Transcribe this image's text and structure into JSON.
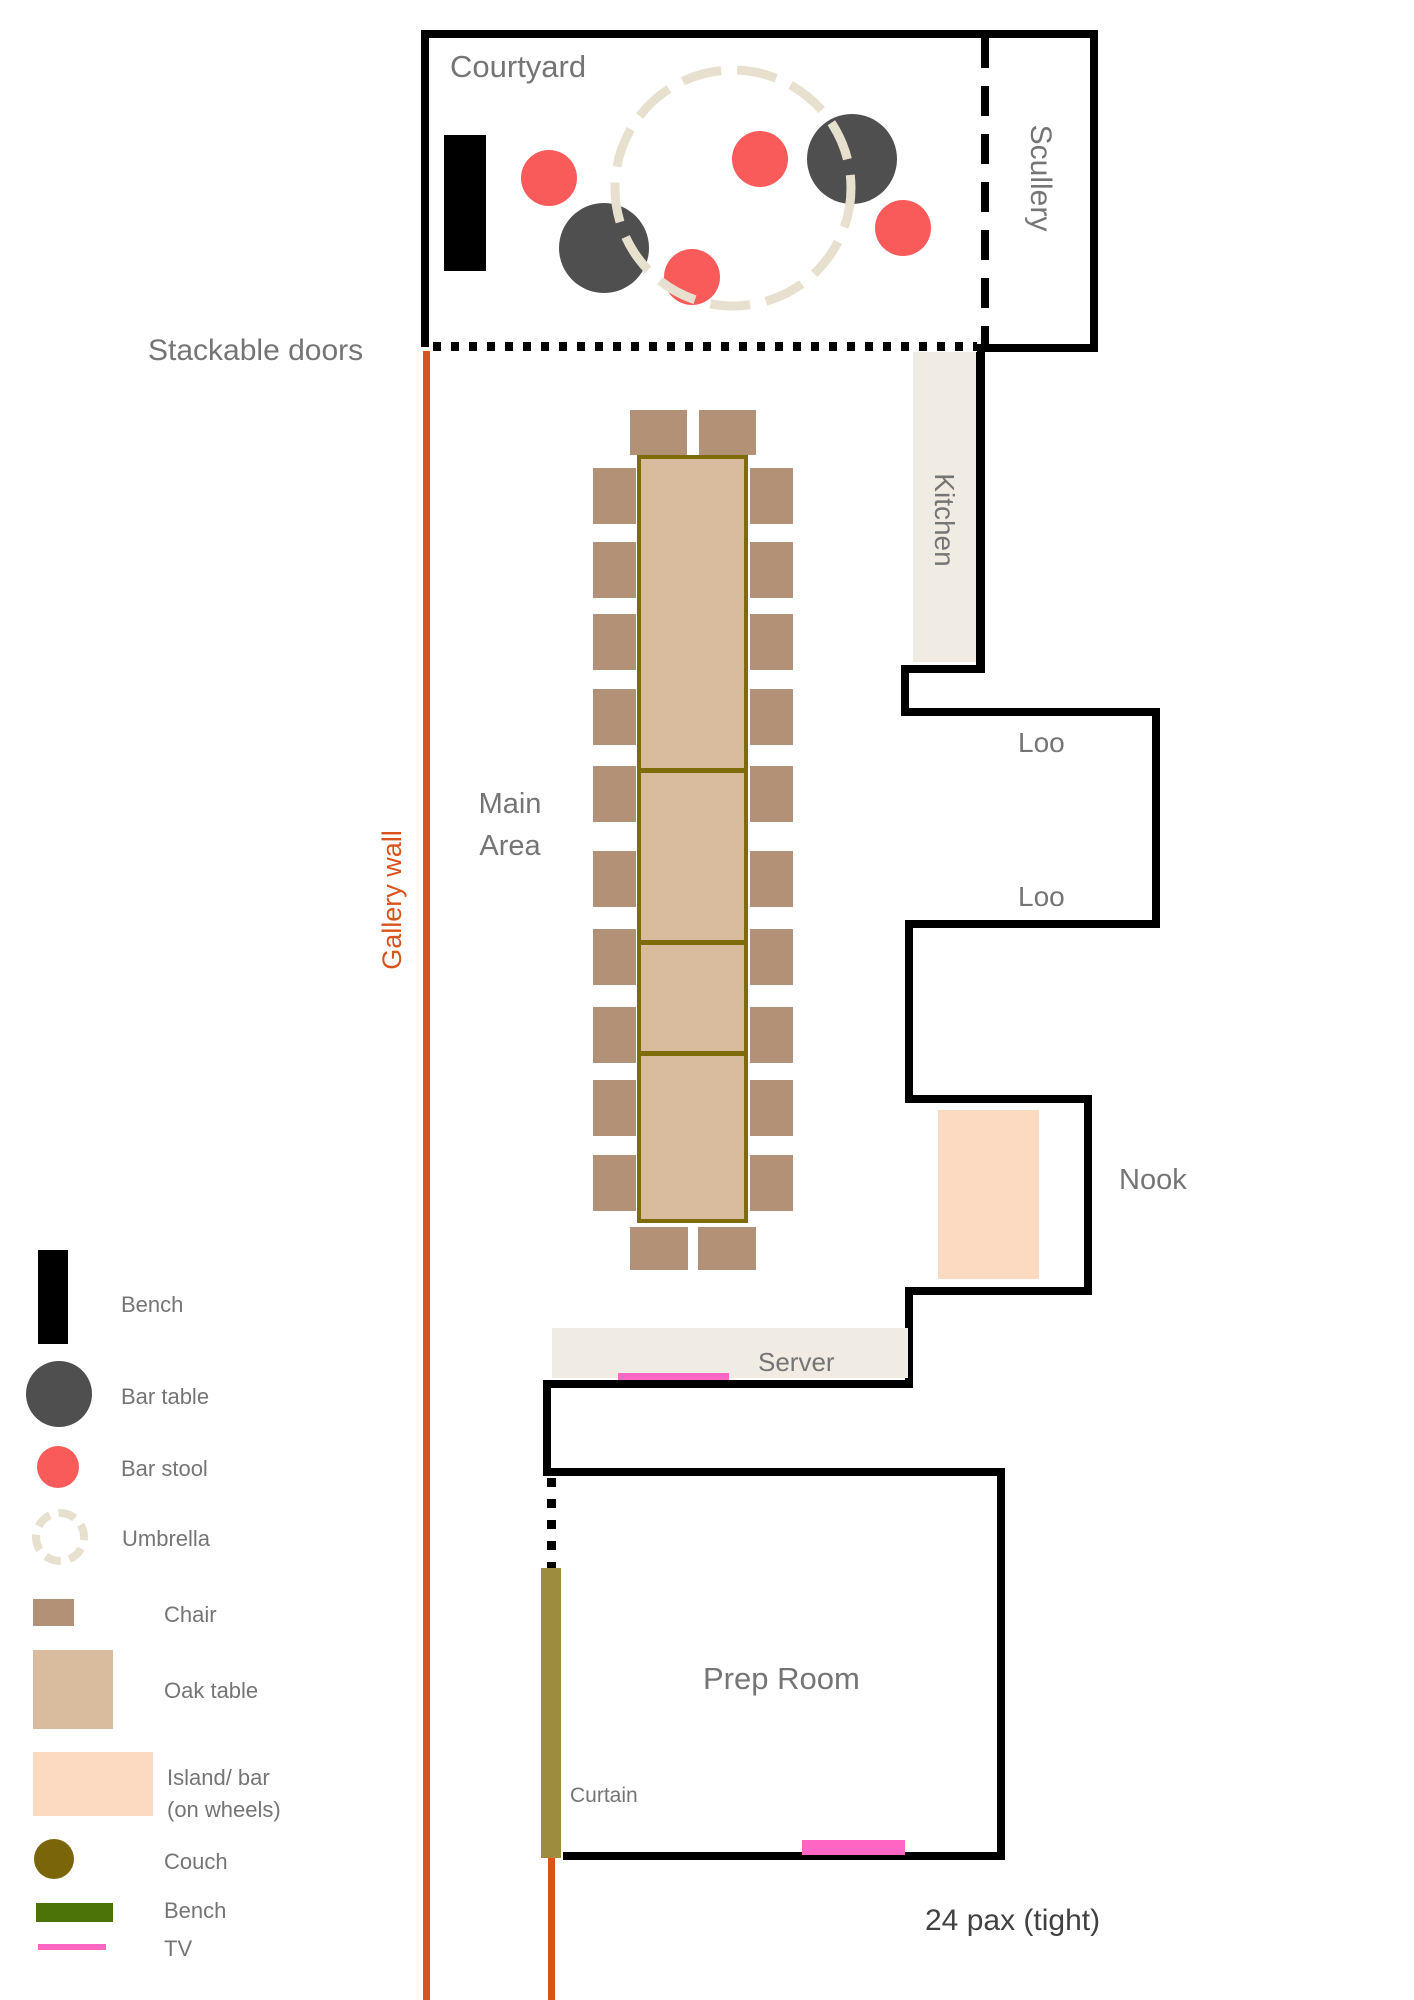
{
  "labels": {
    "courtyard": "Courtyard",
    "scullery": "Scullery",
    "stackable_doors": "Stackable doors",
    "kitchen": "Kitchen",
    "gallery_wall": "Gallery wall",
    "main_area": "Main\nArea",
    "loo_1": "Loo",
    "loo_2": "Loo",
    "nook": "Nook",
    "server": "Server",
    "prep_room": "Prep Room",
    "curtain": "Curtain",
    "capacity_note": "24 pax (tight)"
  },
  "legend": {
    "items": [
      {
        "label": "Bench",
        "swatch": "black-rect",
        "color": "#000000"
      },
      {
        "label": "Bar table",
        "swatch": "dark-circle",
        "color": "#4F4F4F"
      },
      {
        "label": "Bar stool",
        "swatch": "red-circle",
        "color": "#F95B5B"
      },
      {
        "label": "Umbrella",
        "swatch": "dashed-circle",
        "color": "#E8E0CF"
      },
      {
        "label": "Chair",
        "swatch": "brown-rect",
        "color": "#B39177"
      },
      {
        "label": "Oak table",
        "swatch": "tan-rect",
        "color": "#D8BC9D"
      },
      {
        "label": "Island/ bar\n(on wheels)",
        "swatch": "peach-rect",
        "color": "#FCD9C1"
      },
      {
        "label": "Couch",
        "swatch": "olive-circle",
        "color": "#7A6508"
      },
      {
        "label": "Bench",
        "swatch": "green-rect",
        "color": "#4C7307"
      },
      {
        "label": "TV",
        "swatch": "pink-line",
        "color": "#FF66C4"
      }
    ]
  },
  "colors": {
    "wall": "#000000",
    "gallery_wall_line": "#D9531C",
    "room_fill_beige": "#F0ECE4",
    "umbrella": "#E8E0CF",
    "chair": "#B39177",
    "oak_table_fill": "#D8BC9D",
    "oak_table_border": "#7D6C08",
    "island_bar": "#FCD9C1",
    "bar_stool": "#F95B5B",
    "bar_table": "#4F4F4F",
    "couch": "#7A6508",
    "curtain": "#9D8C3E",
    "bench_green": "#4C7307",
    "tv_pink": "#FF66C4",
    "label_gray": "#757575"
  }
}
